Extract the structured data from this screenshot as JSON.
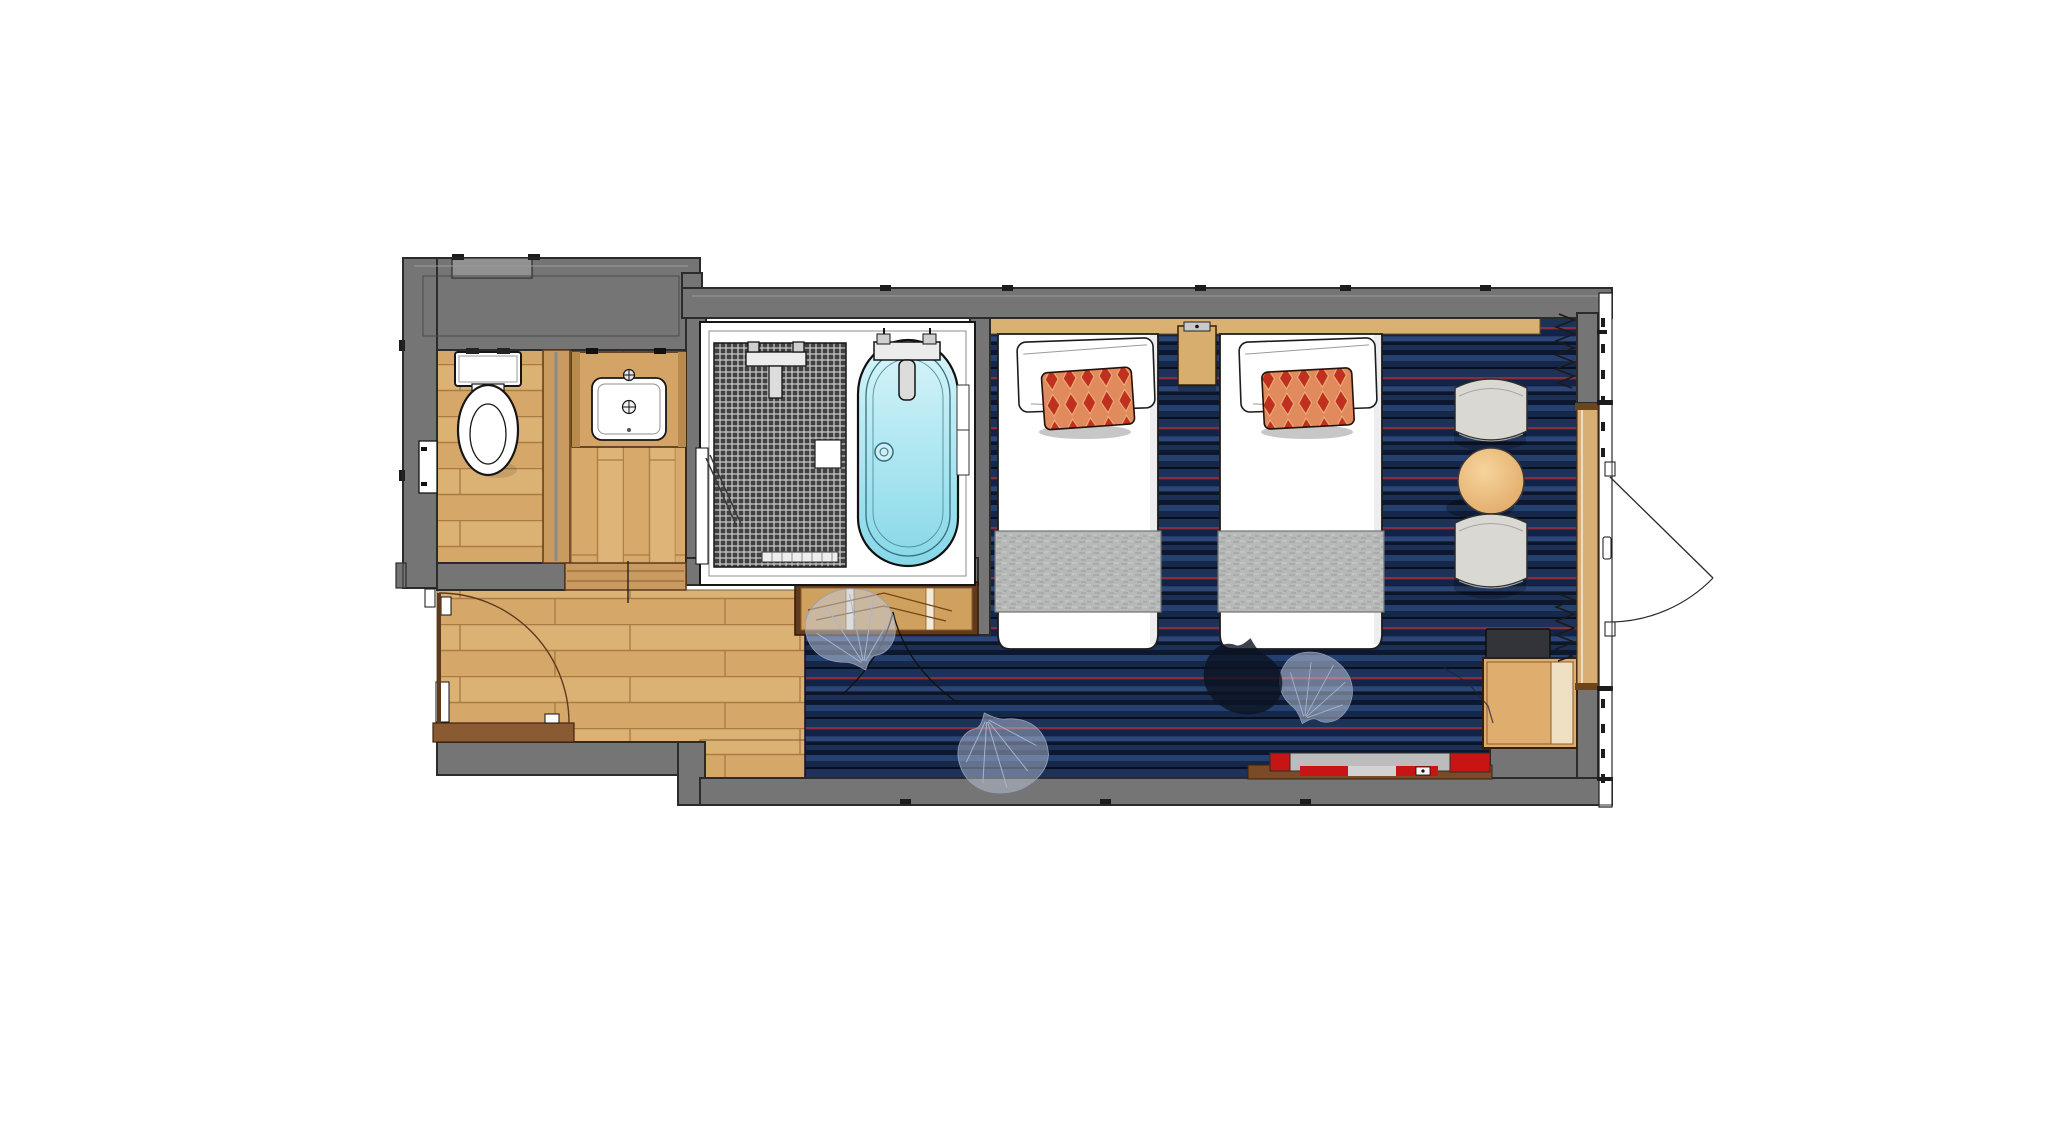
{
  "plan": {
    "title": "Hotel guest room floor plan - twin room",
    "type": "architectural-floor-plan",
    "background": "#ffffff",
    "text_labels": []
  },
  "colors": {
    "wall_fill": "#757575",
    "wall_outline": "#2b2b2b",
    "wood_floor": "#dcb174",
    "wood_joint": "#aa7c45",
    "partition_wood": "#c99b61",
    "carpet_base": "#1b2e54",
    "carpet_dark_stripe": "#0d1830",
    "carpet_light_stripe": "#2b4677",
    "carpet_red_pinstripe": "#8c2d3c",
    "tile_dark": "#414141",
    "tile_grout": "#cfcfcf",
    "tub_water_light": "#d9f4f9",
    "tub_water_deep": "#86d7e8",
    "bed_linen": "#ffffff",
    "bed_runner_gray": "#b6b9b8",
    "pillow_red": "#c0301f",
    "pillow_salmon": "#e08a5e",
    "headboard_wood": "#d9b173",
    "closet_wood": "#d0a05f",
    "furniture_wood": "#dfae6e",
    "chair_fabric": "#d9d8d3",
    "luggage_red": "#c71414",
    "luggage_gray": "#bcbcbc",
    "leaf_motif": "#c3cde0"
  },
  "rooms": [
    {
      "id": "toilet-room",
      "floor": "wood-plank"
    },
    {
      "id": "vanity-room",
      "floor": "wood-plank"
    },
    {
      "id": "shower-room",
      "floor": "dark-mosaic-tile"
    },
    {
      "id": "bath-room",
      "floor": "unit-bath-white"
    },
    {
      "id": "entry-corridor",
      "floor": "wood-plank"
    },
    {
      "id": "bedroom",
      "floor": "striped-navy-carpet"
    }
  ],
  "fixtures": [
    {
      "id": "toilet",
      "room": "toilet-room"
    },
    {
      "id": "washbasin-counter",
      "room": "vanity-room"
    },
    {
      "id": "shower-mixer",
      "room": "shower-room"
    },
    {
      "id": "floor-drain",
      "room": "shower-room"
    },
    {
      "id": "wall-mirror",
      "room": "shower-room"
    },
    {
      "id": "bathtub",
      "room": "bath-room"
    },
    {
      "id": "tub-faucet",
      "room": "bath-room"
    }
  ],
  "furniture": [
    {
      "id": "twin-bed-1",
      "accessories": [
        "white-pillow",
        "red-diamond-pillow",
        "gray-bed-runner"
      ]
    },
    {
      "id": "twin-bed-2",
      "accessories": [
        "white-pillow",
        "red-diamond-pillow",
        "gray-bed-runner"
      ]
    },
    {
      "id": "nightstand",
      "between": [
        "twin-bed-1",
        "twin-bed-2"
      ]
    },
    {
      "id": "headboard-panel"
    },
    {
      "id": "lounge-chair-1"
    },
    {
      "id": "round-side-table"
    },
    {
      "id": "lounge-chair-2"
    },
    {
      "id": "tv-console"
    },
    {
      "id": "tv-unit"
    },
    {
      "id": "luggage-bench",
      "straps": [
        "red",
        "gray",
        "red"
      ]
    },
    {
      "id": "wardrobe-closet"
    }
  ],
  "doors": [
    {
      "id": "connecting-door",
      "wall": "left",
      "swing": "quarter-arc-inward"
    },
    {
      "id": "entrance-door",
      "wall": "right",
      "swing": "quarter-arc-outward"
    },
    {
      "id": "shower-glass-door",
      "wall": "vanity-shower-partition",
      "swing": "ajar-leaf"
    }
  ],
  "decor": [
    {
      "id": "curtain-stack-top",
      "symbol": "zigzag"
    },
    {
      "id": "curtain-stack-bottom",
      "symbol": "zigzag"
    },
    {
      "id": "ginkgo-leaf-motif",
      "count": 4
    },
    {
      "id": "leaf-vine-lines",
      "count": 2
    }
  ]
}
